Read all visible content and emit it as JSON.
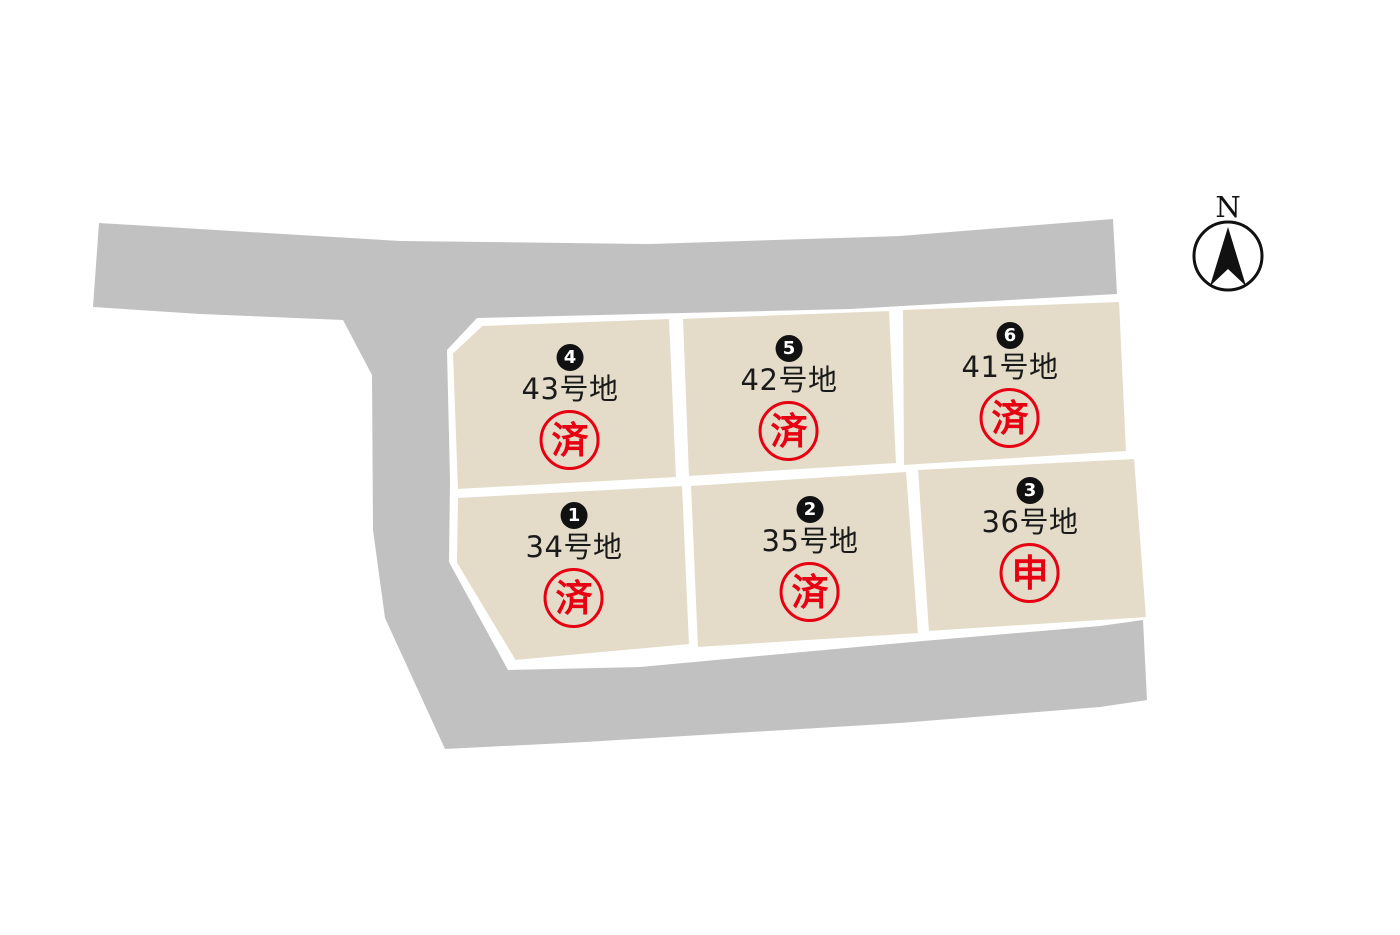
{
  "compass": {
    "label": "N"
  },
  "lots": [
    {
      "number": "1",
      "name": "34号地",
      "status": "済"
    },
    {
      "number": "2",
      "name": "35号地",
      "status": "済"
    },
    {
      "number": "3",
      "name": "36号地",
      "status": "申"
    },
    {
      "number": "4",
      "name": "43号地",
      "status": "済"
    },
    {
      "number": "5",
      "name": "42号地",
      "status": "済"
    },
    {
      "number": "6",
      "name": "41号地",
      "status": "済"
    }
  ],
  "colors": {
    "background": "#ffffff",
    "road": "#c1c1c1",
    "lot_fill": "#e4dcc8",
    "lot_gap": "#ffffff",
    "badge_bg": "#111111",
    "badge_text": "#ffffff",
    "status_red": "#e60012",
    "name_color": "#1a1a1a"
  }
}
